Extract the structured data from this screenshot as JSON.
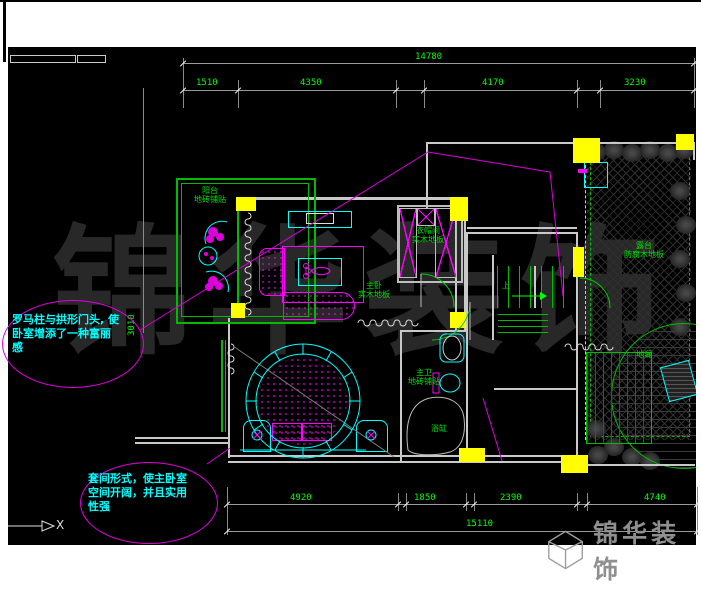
{
  "drawing": {
    "watermark": "锦华装饰"
  },
  "logo": {
    "brand": "锦华装饰"
  },
  "dimensions": {
    "top": {
      "total": "14780",
      "segments": [
        "1510",
        "4350",
        "4170",
        "3230"
      ]
    },
    "bottom": {
      "total": "15110",
      "segments": [
        "4920",
        "1850",
        "2390",
        "4740"
      ]
    },
    "side": {
      "value": "3010"
    }
  },
  "labels": {
    "balcony": "阳台\n地砖铺贴",
    "master_bedroom": "主卧\n实木地板",
    "closet": "衣帽间\n实木地板",
    "master_bath": "主卫\n地砖铺贴",
    "bathtub": "浴缸",
    "terrace": "露台\n防腐木地板",
    "drain": "地漏",
    "stairs_up": "上"
  },
  "annotations": {
    "roman_column_note": "罗马柱与拱形门头, 使\n卧室增添了一种富丽\n感",
    "suite_note": "套间形式，使主卧室\n空间开阔，并且实用\n性强"
  },
  "axis": {
    "x": "X"
  },
  "colors": {
    "line_green": "#00ff00",
    "furniture_magenta": "#ff00ff",
    "accent_cyan": "#00ffff",
    "column_yellow": "#ffff00",
    "wall_gray": "#c9c9c9",
    "background": "#000000"
  }
}
